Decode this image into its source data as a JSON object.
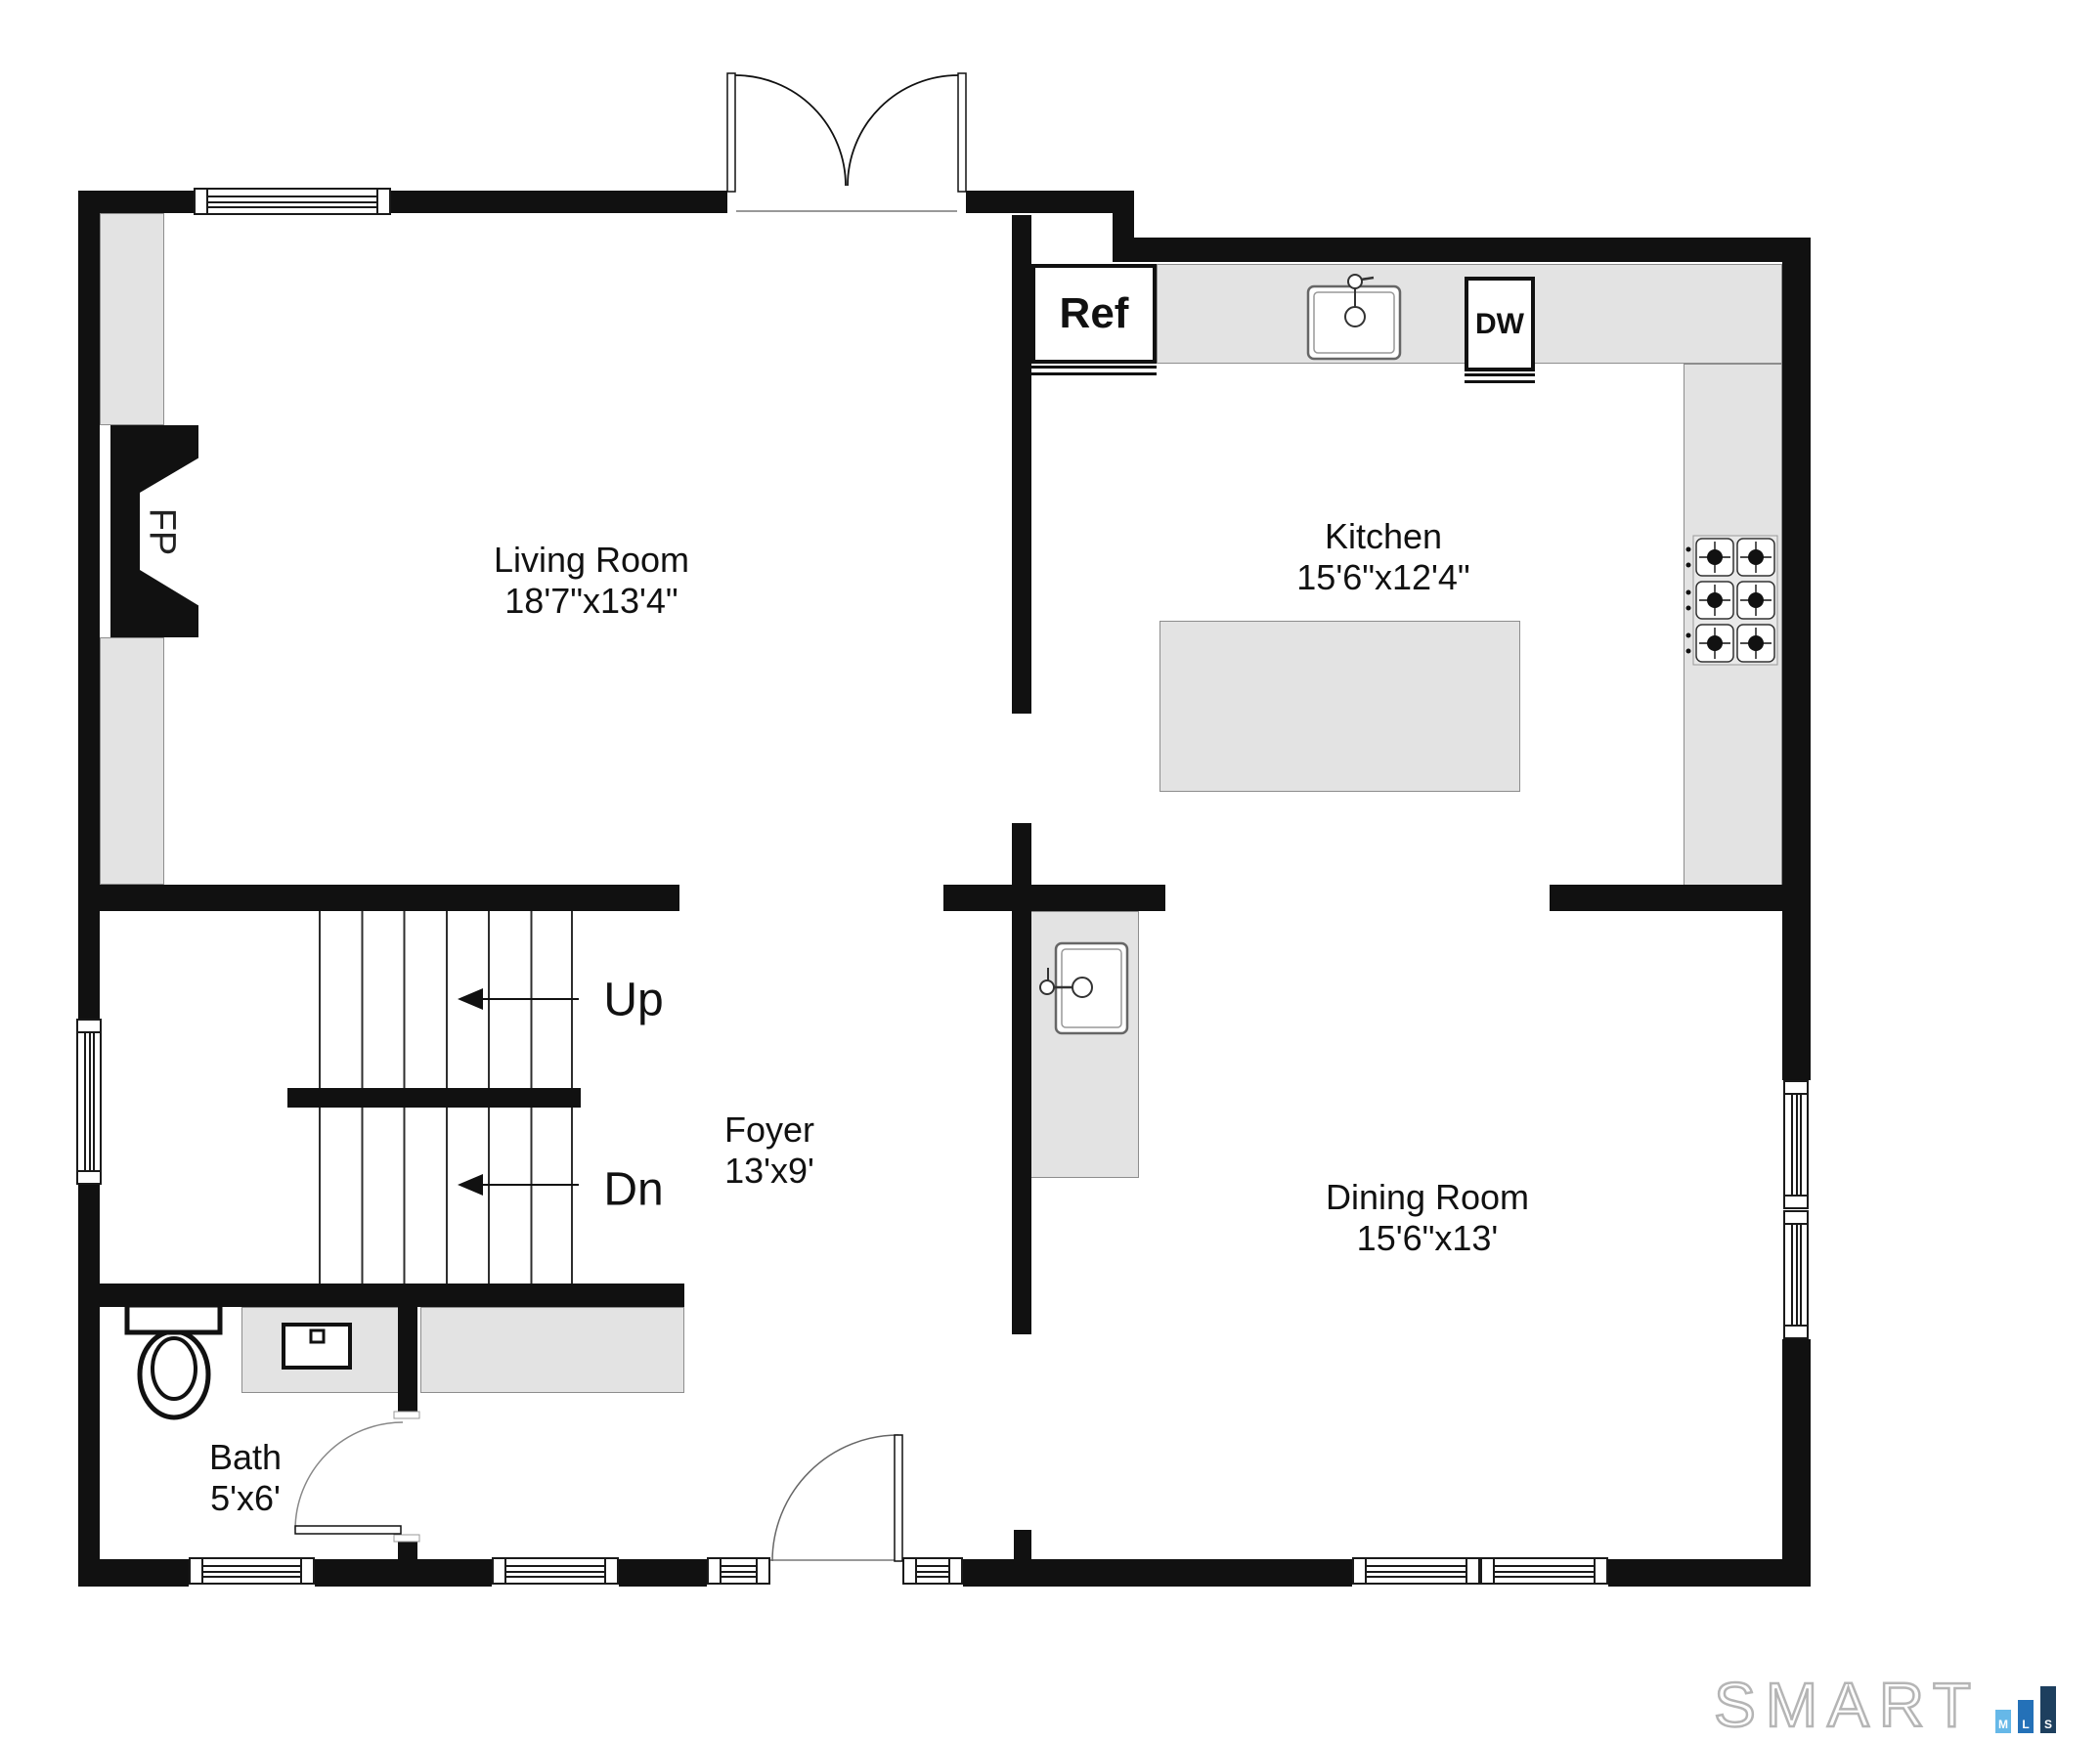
{
  "rooms": {
    "living": {
      "name": "Living Room",
      "dims": "18'7\"x13'4\""
    },
    "kitchen": {
      "name": "Kitchen",
      "dims": "15'6\"x12'4\""
    },
    "foyer": {
      "name": "Foyer",
      "dims": "13'x9'"
    },
    "dining": {
      "name": "Dining Room",
      "dims": "15'6\"x13'"
    },
    "bath": {
      "name": "Bath",
      "dims": "5'x6'"
    }
  },
  "fixtures": {
    "refrigerator": "Ref",
    "dishwasher": "DW",
    "fireplace": "FP"
  },
  "stairs": {
    "up_label": "Up",
    "down_label": "Dn"
  },
  "branding": {
    "logo": "SMART",
    "mls_letters": [
      "M",
      "L",
      "S"
    ]
  },
  "colors": {
    "wall": "#111111",
    "counter_fill": "#e3e3e3",
    "mls_light_blue": "#66b8e8",
    "mls_mid_blue": "#2471b8",
    "mls_navy": "#1d3f5e"
  }
}
